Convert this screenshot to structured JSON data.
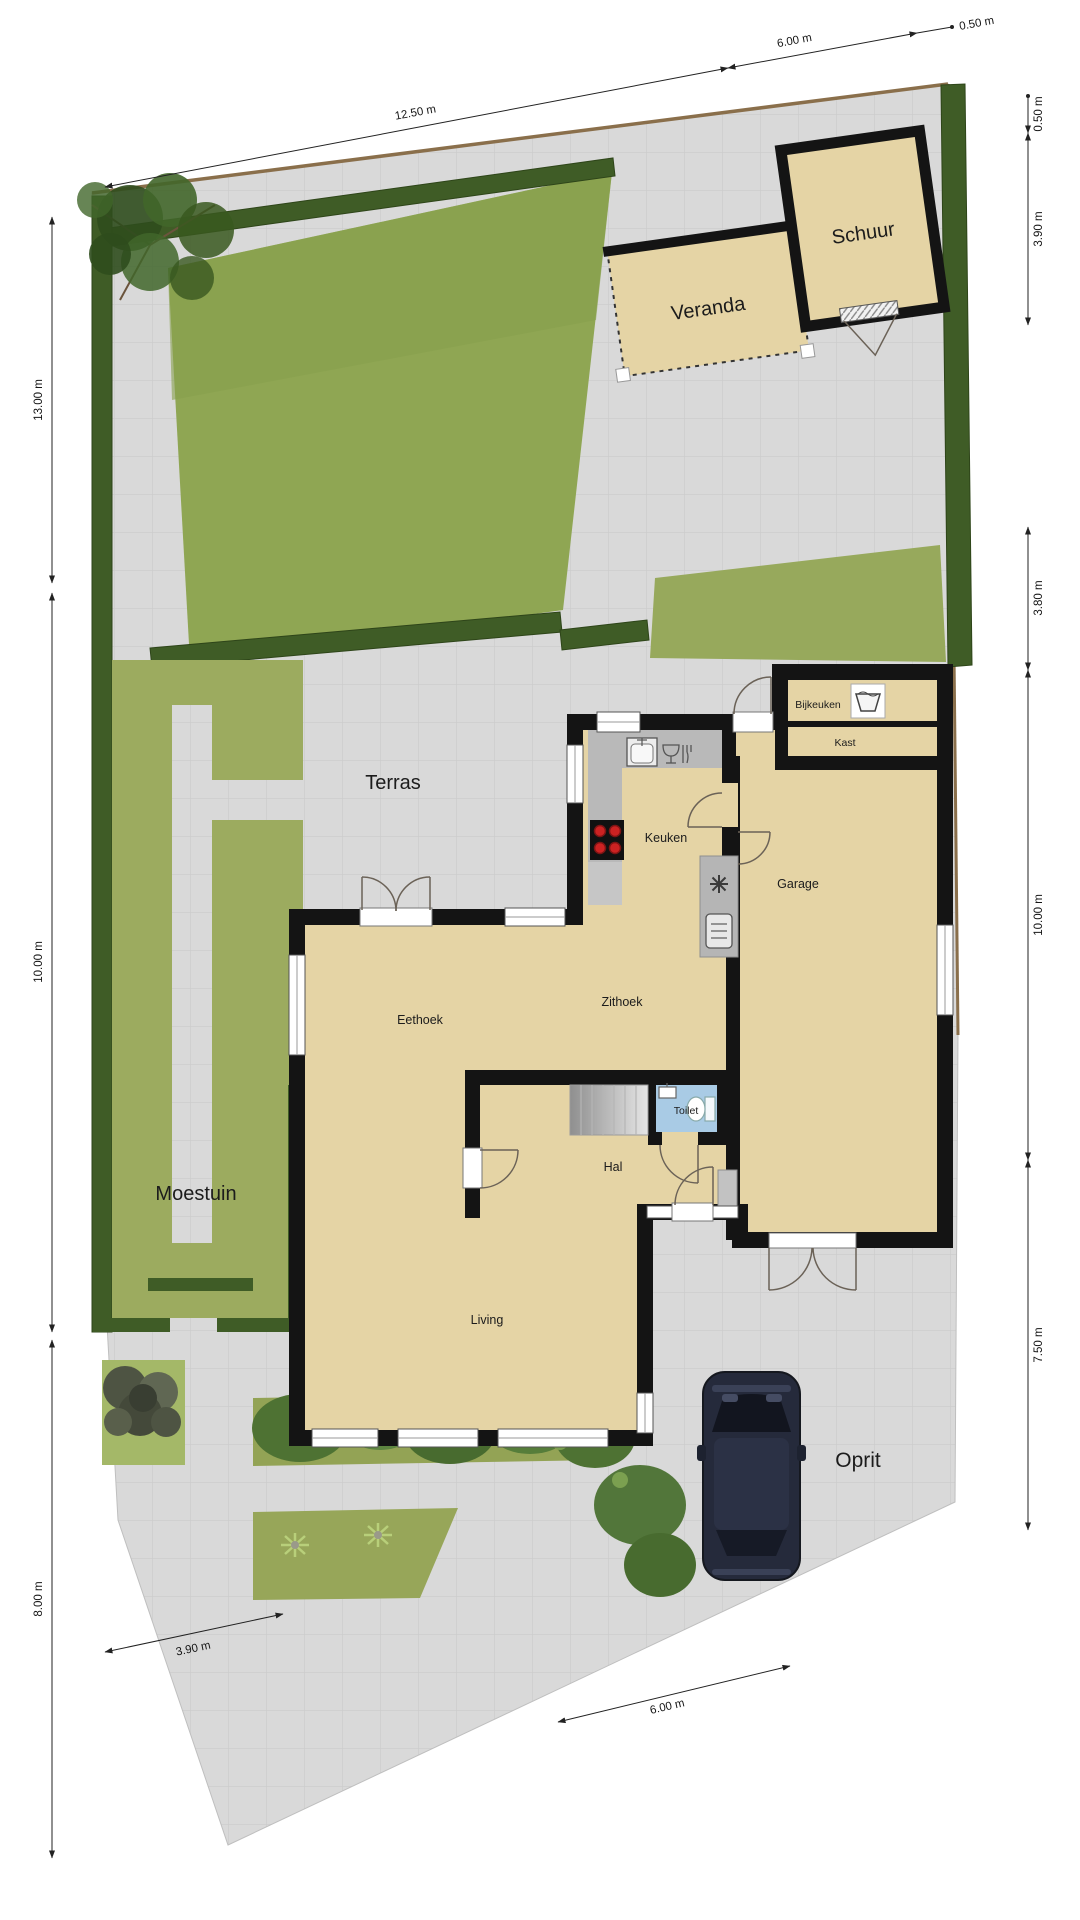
{
  "plan": {
    "type": "residential site / floor plan",
    "areas": {
      "terras": "Terras",
      "moestuin": "Moestuin",
      "oprit": "Oprit",
      "veranda": "Veranda",
      "schuur": "Schuur"
    },
    "rooms": {
      "keuken": "Keuken",
      "bijkeuken": "Bijkeuken",
      "kast": "Kast",
      "zithoek": "Zithoek",
      "eethoek": "Eethoek",
      "garage": "Garage",
      "toilet": "Toilet",
      "hal": "Hal",
      "living": "Living"
    },
    "dimensions": {
      "top_left": "12.50 m",
      "top_mid": "6.00 m",
      "top_right": "0.50 m",
      "right_1": "0.50 m",
      "right_2": "3.90 m",
      "right_3": "3.80 m",
      "right_4": "10.00 m",
      "right_5": "7.50 m",
      "left_1": "13.00 m",
      "left_2": "10.00 m",
      "left_3": "8.00 m",
      "bottom_left": "3.90 m",
      "bottom_right": "6.00 m"
    },
    "colors": {
      "pavement": "#d9d9d9",
      "pavement_grid": "#c9c9c9",
      "lawn": "#8fa653",
      "moestuin_lawn": "#9cab5f",
      "hedge": "#3f5c26",
      "room_fill": "#e5d4a5",
      "wall": "#141414",
      "counter_gray": "#b9b9b9",
      "toilet_blue": "#a9cbe5",
      "fence_brown": "#8a6f4b",
      "car_body": "#252a3b",
      "stove_burner": "#cc2222"
    },
    "icons": {
      "kitchen": [
        "sink-icon",
        "dishwasher-icon",
        "stove-icon"
      ],
      "bijkeuken": [
        "washtub-icon"
      ],
      "technical": [
        "fan-icon",
        "boiler-icon"
      ],
      "toilet": [
        "washbasin-icon",
        "toilet-bowl-icon"
      ]
    }
  }
}
